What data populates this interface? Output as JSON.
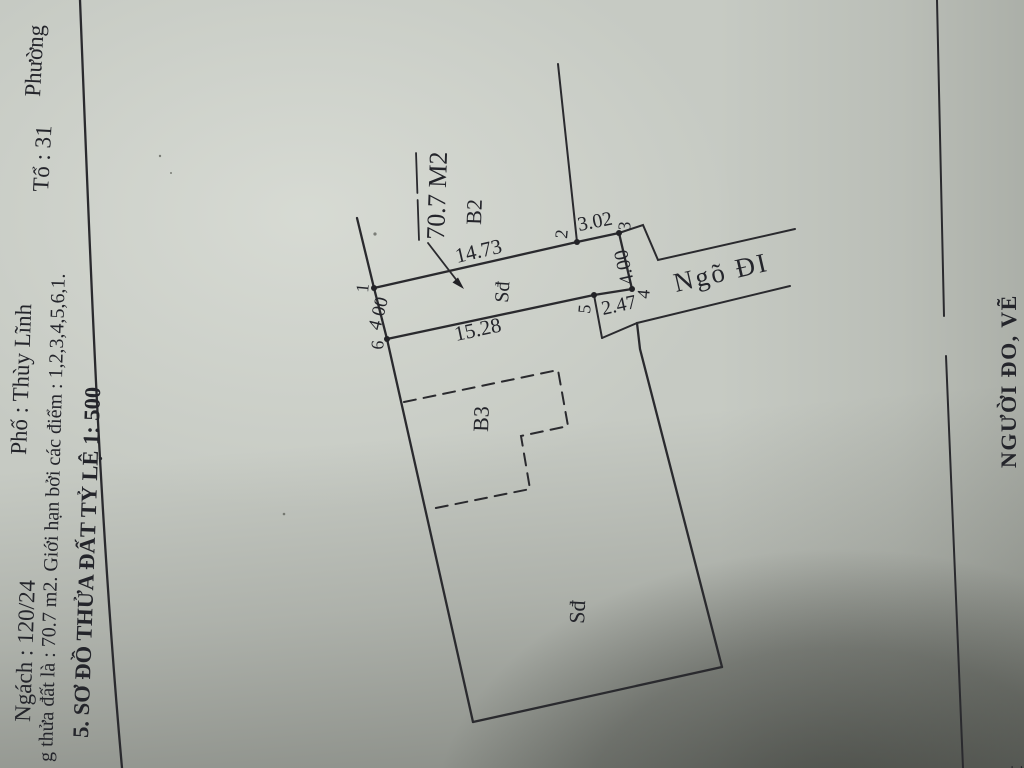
{
  "colors": {
    "paper": "#c6cac3",
    "ink": "#2a2a2e",
    "text_ink": "#24252b"
  },
  "header": {
    "line1": {
      "ngach": "Ngách : 120/24",
      "pho": "Phố : Thùy Lĩnh",
      "to": "Tổ : 31",
      "phuong": "Phường"
    },
    "line2": "g thửa đất là :  70.7   m2. Giới hạn bởi các điểm : 1,2,3,4,5,6,1.",
    "section_title": "5. SƠ ĐỒ THỬA ĐẤT  TỶ LỆ   1: 500"
  },
  "sketch": {
    "area_label": "70.7 M2",
    "neighbors": {
      "top": "B2",
      "bottom_left": "B3"
    },
    "land_labels": {
      "strip": "Sđ",
      "main": "Sđ"
    },
    "alley": "Ngõ ĐI",
    "vertices": [
      "1",
      "2",
      "3",
      "4",
      "5",
      "6"
    ],
    "dimensions": {
      "d12": "14.73",
      "d23": "3.02",
      "d34": "4.00",
      "d45": "2.47",
      "d56": "15.28",
      "d61": "4.00"
    }
  },
  "footer": {
    "surveyor": "NGƯỜI ĐO, VẼ",
    "corner_fragment": "đất"
  }
}
